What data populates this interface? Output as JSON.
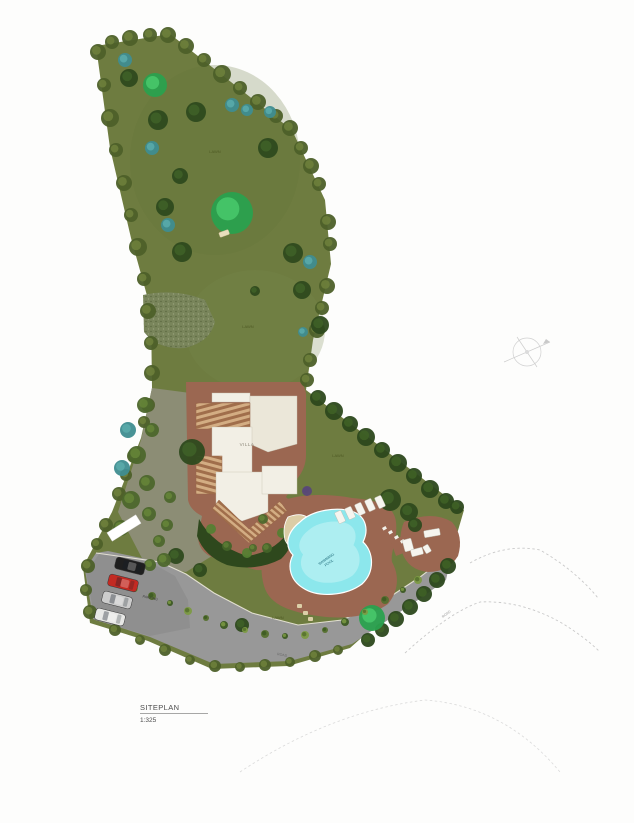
{
  "title": {
    "label": "SITEPLAN",
    "scale": "1:325"
  },
  "plan": {
    "labels": {
      "villa": "VILLA",
      "pool_line1": "SWIMMING",
      "pool_line2": "POOL",
      "lawn": "LAWN",
      "road": "ROAD",
      "parking": "PARKING"
    },
    "colors": {
      "lawn": "#6e7c40",
      "paving": "#9b6751",
      "pool": "#8ce7ec",
      "pool_light": "#c9f4f5",
      "road": "#989898",
      "parking": "#8f8f8f",
      "building": "#f2efe5",
      "terrace_cream": "#ebe7d9",
      "deck_light": "#d3ad83",
      "deck_dark": "#a06e4b",
      "gravel": "#8c8d75",
      "tree_dark": "#2e4a1e",
      "tree_dark_in": "#3f6128",
      "tree_bright": "#2aa14e",
      "tree_bright_in": "#49c96c",
      "tree_teal": "#3f8d90",
      "tree_teal_in": "#5aabac",
      "tree_mixed": "#4d672c",
      "tree_mixed_in": "#668638",
      "edge_tree": "#4d6029",
      "edge_tree_light": "#6e813c",
      "hedge": "#2c481c",
      "hedge_light": "#3f6126",
      "purple_shrub": "#584878",
      "bed": "#2e481d",
      "furniture": "#f6f5ef",
      "stone_white": "#f2f0e8",
      "stone_tan": "#dccfa8",
      "shrub_cycle": [
        "#3c5a22",
        "#7c9a43",
        "#55702e"
      ]
    },
    "trees": {
      "dark": [
        [
          129,
          78,
          9
        ],
        [
          158,
          120,
          10
        ],
        [
          196,
          112,
          10
        ],
        [
          268,
          148,
          10
        ],
        [
          180,
          176,
          8
        ],
        [
          165,
          207,
          9
        ],
        [
          182,
          252,
          10
        ],
        [
          293,
          253,
          10
        ],
        [
          302,
          290,
          9
        ],
        [
          320,
          325,
          9
        ],
        [
          255,
          291,
          5
        ],
        [
          192,
          452,
          13
        ],
        [
          390,
          500,
          11
        ],
        [
          409,
          512,
          9
        ],
        [
          415,
          525,
          7
        ],
        [
          176,
          556,
          8
        ],
        [
          200,
          570,
          7
        ],
        [
          242,
          625,
          7
        ]
      ],
      "bright": [
        [
          155,
          85,
          12
        ],
        [
          232,
          213,
          21
        ],
        [
          372,
          618,
          13
        ]
      ],
      "teal": [
        [
          125,
          60,
          7
        ],
        [
          232,
          105,
          7
        ],
        [
          247,
          110,
          6
        ],
        [
          270,
          112,
          6
        ],
        [
          152,
          148,
          7
        ],
        [
          168,
          225,
          7
        ],
        [
          310,
          262,
          7
        ],
        [
          303,
          332,
          5
        ],
        [
          128,
          430,
          8
        ],
        [
          122,
          468,
          8
        ]
      ],
      "mixed": [
        [
          145,
          405,
          8
        ],
        [
          152,
          430,
          7
        ],
        [
          137,
          455,
          9
        ],
        [
          147,
          483,
          8
        ],
        [
          131,
          500,
          9
        ],
        [
          149,
          514,
          7
        ],
        [
          121,
          528,
          8
        ],
        [
          159,
          541,
          6
        ],
        [
          167,
          525,
          6
        ],
        [
          170,
          497,
          6
        ],
        [
          164,
          560,
          7
        ],
        [
          150,
          565,
          6
        ],
        [
          263,
          519,
          5
        ],
        [
          253,
          548,
          4
        ]
      ],
      "purple": [
        [
          307,
          491,
          5
        ]
      ]
    },
    "shrubs": [
      [
        120,
        583,
        4
      ],
      [
        135,
        589,
        3
      ],
      [
        152,
        596,
        4
      ],
      [
        170,
        603,
        3
      ],
      [
        188,
        611,
        4
      ],
      [
        206,
        618,
        3
      ],
      [
        224,
        625,
        4
      ],
      [
        245,
        630,
        3
      ],
      [
        265,
        634,
        4
      ],
      [
        285,
        636,
        3
      ],
      [
        305,
        635,
        4
      ],
      [
        325,
        630,
        3
      ],
      [
        345,
        622,
        4
      ],
      [
        365,
        612,
        3
      ],
      [
        385,
        600,
        4
      ],
      [
        403,
        590,
        3
      ],
      [
        418,
        580,
        4
      ]
    ],
    "edge_trees": [
      [
        98,
        52,
        8
      ],
      [
        104,
        85,
        7
      ],
      [
        110,
        118,
        9
      ],
      [
        116,
        150,
        7
      ],
      [
        124,
        183,
        8
      ],
      [
        131,
        215,
        7
      ],
      [
        138,
        247,
        9
      ],
      [
        144,
        279,
        7
      ],
      [
        148,
        311,
        8
      ],
      [
        151,
        343,
        7
      ],
      [
        152,
        373,
        8
      ],
      [
        112,
        42,
        7
      ],
      [
        130,
        38,
        8
      ],
      [
        150,
        35,
        7
      ],
      [
        168,
        35,
        8
      ],
      [
        186,
        46,
        8
      ],
      [
        204,
        60,
        7
      ],
      [
        222,
        74,
        9
      ],
      [
        240,
        88,
        7
      ],
      [
        258,
        102,
        8
      ],
      [
        276,
        116,
        7
      ],
      [
        290,
        128,
        8
      ],
      [
        301,
        148,
        7
      ],
      [
        311,
        166,
        8
      ],
      [
        319,
        184,
        7
      ],
      [
        328,
        222,
        8
      ],
      [
        330,
        244,
        7
      ],
      [
        327,
        286,
        8
      ],
      [
        322,
        308,
        7
      ],
      [
        317,
        330,
        8
      ],
      [
        310,
        360,
        7
      ],
      [
        307,
        380,
        7
      ],
      [
        148,
        405,
        7
      ],
      [
        144,
        422,
        6
      ],
      [
        134,
        456,
        7
      ],
      [
        126,
        475,
        6
      ],
      [
        119,
        494,
        7
      ],
      [
        106,
        525,
        7
      ],
      [
        97,
        544,
        6
      ],
      [
        88,
        566,
        7
      ],
      [
        86,
        590,
        6
      ],
      [
        90,
        612,
        7
      ],
      [
        115,
        630,
        6
      ],
      [
        140,
        640,
        5
      ],
      [
        165,
        650,
        6
      ],
      [
        190,
        660,
        5
      ],
      [
        215,
        666,
        6
      ],
      [
        240,
        667,
        5
      ],
      [
        265,
        665,
        6
      ],
      [
        290,
        662,
        5
      ],
      [
        315,
        656,
        6
      ],
      [
        338,
        650,
        5
      ]
    ],
    "hedge_ne": [
      [
        318,
        398,
        8
      ],
      [
        334,
        411,
        9
      ],
      [
        350,
        424,
        8
      ],
      [
        366,
        437,
        9
      ],
      [
        382,
        450,
        8
      ],
      [
        398,
        463,
        9
      ],
      [
        414,
        476,
        8
      ],
      [
        430,
        489,
        9
      ],
      [
        446,
        501,
        8
      ],
      [
        457,
        507,
        7
      ]
    ],
    "hedge_se": [
      [
        448,
        566,
        8
      ],
      [
        437,
        580,
        8
      ],
      [
        424,
        594,
        8
      ],
      [
        410,
        607,
        8
      ],
      [
        396,
        619,
        8
      ],
      [
        382,
        630,
        7
      ],
      [
        368,
        640,
        7
      ]
    ],
    "bed_shrubs": [
      [
        211,
        529,
        5
      ],
      [
        227,
        546,
        5
      ],
      [
        247,
        553,
        5
      ],
      [
        267,
        548,
        5
      ],
      [
        282,
        533,
        5
      ]
    ],
    "cars": [
      {
        "name": "car-black",
        "x": 130,
        "y": 566,
        "angle": 14,
        "color": "#1f1f1f"
      },
      {
        "name": "car-red",
        "x": 123,
        "y": 583,
        "angle": 14,
        "color": "#c32a22"
      },
      {
        "name": "car-silver",
        "x": 117,
        "y": 600,
        "angle": 14,
        "color": "#cccccc"
      },
      {
        "name": "car-white",
        "x": 110,
        "y": 617,
        "angle": 14,
        "color": "#e8e8e6"
      }
    ],
    "loungers": [
      [
        340,
        517
      ],
      [
        350,
        513
      ],
      [
        360,
        509
      ],
      [
        370,
        505
      ],
      [
        380,
        502
      ]
    ],
    "furniture": [
      [
        432,
        533,
        16,
        7,
        -10
      ],
      [
        408,
        545,
        9,
        12,
        -15
      ],
      [
        417,
        552,
        12,
        7,
        -15
      ],
      [
        427,
        549,
        8,
        6,
        60
      ]
    ],
    "stones_white": [
      [
        382,
        528
      ],
      [
        388,
        532
      ],
      [
        394,
        537
      ],
      [
        400,
        541
      ],
      [
        405,
        545
      ]
    ],
    "stones_tan": [
      [
        297,
        604
      ],
      [
        303,
        611
      ],
      [
        308,
        617
      ]
    ]
  }
}
